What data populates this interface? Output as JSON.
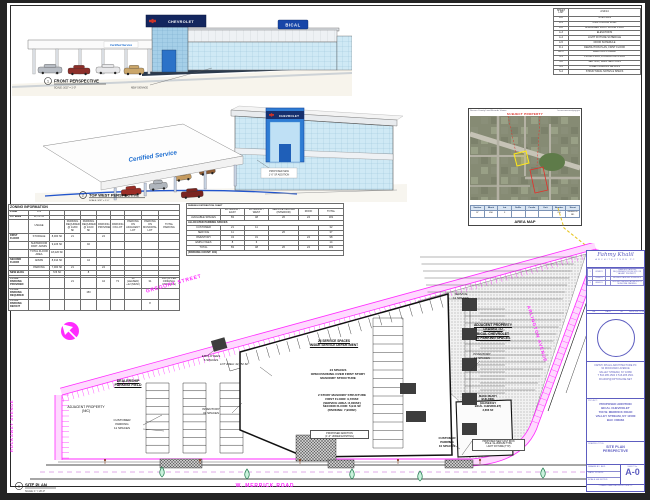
{
  "colors": {
    "magenta": "#ff2bff",
    "purple": "#5d5dc0",
    "red_note": "#d92b20",
    "yellow": "#e7c51f",
    "sign_navy": "#16306e",
    "tower_blue": "#2e7cd4",
    "glass": "#cfe9f5",
    "tree_green": "#c9f2dc"
  },
  "perspective1": {
    "number": "1",
    "title": "FRONT PERSPECTIVE",
    "scale": "SCALE: 3/32\" = 1'-0\"",
    "sign_chevrolet": "CHEVROLET",
    "sign_bical": "BICAL",
    "sign_certified": "Certified Service",
    "note": "NEW SIGNAGE"
  },
  "perspective2": {
    "number": "2",
    "title": "TOP WEST PERSPECTIVE",
    "scale": "SCALE: 3/32\" = 1'-0\"",
    "sign_chevrolet": "CHEVROLET",
    "sign_certified": "Certified Service",
    "note_l1": "PROPOSED NEW",
    "note_l2": "1'-0\" SF ADDITION"
  },
  "sheet_list": {
    "rows": [
      [
        "SHEET LIST",
        "2/14/14"
      ],
      [
        "A-0",
        "SITE PLAN"
      ],
      [
        "A-1",
        "FIRST FLOOR PLAN"
      ],
      [
        "A-2",
        "ENLARGED FIRST FLOOR PLAN"
      ],
      [
        "A-3",
        "ELEVATIONS"
      ],
      [
        "A-4",
        "LIGHT FIXTURE SCHEDULE"
      ],
      [
        "A-5",
        "DOOR SCHEDULE"
      ],
      [
        "D-1",
        "DEMOLITION PLAN, FIRST FLOOR"
      ],
      [
        "EL-1",
        "ELECTRIC POWER"
      ],
      [
        "S-1",
        "PILING PLAN, FOUNDATION PLAN"
      ],
      [
        "S-2",
        "SECTION, WALL SECTIONS"
      ],
      [
        "S-3",
        "STEEL FRAMING DETAILS"
      ],
      [
        "S-4",
        "STRUCTURAL NOTES & SPECS"
      ]
    ]
  },
  "area_map": {
    "header_left": "Nassau County Land Records Viewer",
    "header_right": "lrv.nassaucountyny.gov",
    "subject": "SUBJECT PROPERTY",
    "caption": "AREA MAP",
    "table": [
      [
        "Section",
        "Block",
        "Lot",
        "Suffix",
        "Condo",
        "Unit",
        "Number",
        "Street"
      ],
      [
        "37",
        "456",
        "3",
        "",
        "",
        "",
        "700",
        "MERRICK RD"
      ]
    ]
  },
  "zoning": {
    "rows": [
      [
        {
          "t": "ZONING INFORMATION",
          "s": 10,
          "c": "title"
        }
      ],
      [
        "ZONE",
        "C-2",
        "",
        "",
        "",
        "",
        "",
        "",
        "",
        ""
      ],
      [
        "LOT AREA",
        "44,752 SF",
        "",
        "",
        "",
        "",
        "",
        "",
        "",
        ""
      ],
      [
        "",
        "USAGE",
        "",
        "PARKING REQUIRED @ 1/200 SF",
        "PARKING REQUIRED @ 1/100 SF",
        "PARKING PROVIDED",
        "PARKING ON LOT",
        "PARKING ON ADJACENT LOT",
        "PARKING ON MUNICIPAL LOT",
        "TOTAL PARKING"
      ],
      [
        "FIRST FLOOR",
        "STORAGE",
        "8,000 SF",
        "21",
        "",
        "24",
        "",
        "",
        "",
        ""
      ],
      [
        "",
        "SHOWROOM PART. ADMIN",
        "9,226 SF",
        "",
        "92",
        "",
        "",
        "",
        "",
        ""
      ],
      [
        "",
        "TOTAL FLOOR AREA",
        "18,226 SF",
        "",
        "",
        "",
        "",
        "",
        "",
        ""
      ],
      [
        "SECOND FLOOR",
        "ADMIN",
        "8,914 SF",
        "",
        "44",
        "",
        "",
        "",
        "",
        ""
      ],
      [
        "",
        "PARKING",
        "7,000 SF",
        "21",
        "",
        "24",
        "",
        "",
        "",
        ""
      ],
      [
        "NEW BLDG",
        "",
        "726 SF",
        "",
        "8",
        "",
        "",
        "",
        "",
        ""
      ],
      [
        "",
        "",
        "",
        "",
        "",
        "",
        "",
        "",
        "",
        ""
      ],
      [
        "TOTAL PARKING PROVIDED",
        "",
        "",
        "21",
        "",
        "44",
        "73",
        "30 (LEASED) +12 (MUNI)",
        "31",
        "162 (66 PER ORIGINAL VARIANCE)"
      ],
      [
        "TOTAL PARKING REQUIRED",
        "",
        "",
        "",
        "150",
        "",
        "",
        "",
        "",
        ""
      ],
      [
        "TOTAL PARKING DEFICIT",
        "",
        "",
        "",
        "",
        "",
        "",
        "",
        "8",
        ""
      ]
    ]
  },
  "parking_chart": {
    "rows": [
      [
        {
          "t": "PARKING DISTRIBUTION CHART",
          "s": 6,
          "c": "title"
        }
      ],
      [
        "",
        "EXTERIOR - EAST",
        "EXTERIOR / WEST",
        "SERVICE CENTER (INTERIOR)",
        "ROOF",
        "TOTAL"
      ],
      [
        "AVAILABLE SPACES",
        "83",
        "48",
        "26",
        "24",
        "181"
      ],
      [
        {
          "t": "ALLOCATED PARKING SPACES",
          "s": 6,
          "c": "sec"
        }
      ],
      [
        "CUSTOMER",
        "21",
        "11",
        "",
        "",
        "32"
      ],
      [
        "SERVICE",
        "11",
        "",
        "26",
        "",
        "37"
      ],
      [
        "INVENTORY",
        "43",
        "31",
        "",
        "24",
        "98"
      ],
      [
        "EMPLOYEES",
        "8",
        "6",
        "",
        "",
        "14"
      ],
      [
        "TOTAL",
        "83",
        "48",
        "26",
        "24",
        "181"
      ],
      [
        {
          "t": "(PARKING COUNT: 181)",
          "s": 6,
          "c": "sec"
        }
      ]
    ]
  },
  "site_plan": {
    "streets": {
      "top": "GREGORY STREET",
      "right": "ARLINGTON AVENUE",
      "bottom": "W. MERRICK ROAD",
      "left": "ROCKAWAY AVENUE"
    },
    "labels": {
      "employees": "EMPLOYEES\n6 SPACES",
      "dealership": "DEALERSHIP\nPARKING FIELD",
      "adjacent_nic": "ADJACENT PROPERTY\n(NIC)",
      "customer_11": "CUSTOMER\nPARKING\n11 SPACES",
      "inventory_31": "INVENTORY\n31 SPACES",
      "lot_area": "LOT AREA: 44,752 SF",
      "service_26": "26 SERVICE SPACES\nINSIDE SERVICE DEPARTMENT",
      "open_24": "24 SPACES\nOPEN PARKING OVER FIRST STORY\nMASONRY STRUCTURE",
      "bldg_note": "2 STORY MASONRY STRUCTURE\nFIRST FLOOR: 9,726SF\n(SERVICE AREA: 8,000SF)\nSECOND FLOOR: 5,941 SF\n(PARKING: 7,900SF)",
      "addition_note": "PROPOSED ADDITION\n(1'-0\" UNDER EXISTING)",
      "adjacent_leased": "ADJACENT PROPERTY\nLEASED TO\nBICAL CHEVROLET\n30 PARKING SPACES",
      "service_11": "SERVICE\n11 SPACES",
      "inventory_12": "INVENTORY\n12 SPACES",
      "make_ready": "MAKE READY\nBUILDING\n(LEASED BY\nBICAL CHEVROLET)\n3,666 SF",
      "customer_10": "CUSTOMER\nPARKING\n10 SPACES",
      "light_note": "PROPOSED NEW CAST IRON\nPOLE / ALUMINUM TYPE\nLIGHT FIXTURE (TYP)"
    },
    "plan_label": {
      "number": "1",
      "title": "SITE PLAN",
      "scale": "SCALE: 1\" = 20'-0\""
    }
  },
  "title_block": {
    "logo_script": "Fahmy Khalil",
    "logo_sub": "ARCHITECTURE PC",
    "rev_headers": [
      "No.",
      "DATE",
      "BY",
      "DESCRIPTION"
    ],
    "revisions": [
      [
        "1",
        "02/08/21",
        "",
        "CHANGED PARKING REQUIREMENT FROM SITE ON VACANT PROPERTY"
      ],
      [
        "2",
        "03/08/21",
        "",
        "REVISED PARKING SCHEDULE"
      ],
      [
        "3",
        "08/09/21",
        "",
        "REVISED PARKING ADJACENT & MUNICIPAL PARKING"
      ]
    ],
    "architect_lines": "FAHMY KHALIL ARCHITECTURE PC\n90 ROCKAWAY AVENUE\nVALLEY STREAM, NY 11580\nT 516.285.1500  F 516.285.1501\nFKARCH@OPTONLINE.NET",
    "project_label": "PROJECT:",
    "project_lines": "PROPOSED ADDITION\nBICAL CHEVROLET\n700 W. MERRICK ROAD\nVALLEY STREAM, NY 11580\nBAC #06984",
    "drawing_title_label": "DRAWING TITLE:",
    "drawing_title": "SITE PLAN\nPERSPECTIVE",
    "drawn_label": "DRAWN BY:",
    "drawn": "BK/L",
    "date_label": "DATE:",
    "date": "11/16/20",
    "scale_label": "SCALE:",
    "scale": "AS NOTED",
    "sheet_label": "SHEET No.",
    "sheet_no": "A-0",
    "note": "© FAHMY KHALIL ARCHITECTURE PC"
  }
}
